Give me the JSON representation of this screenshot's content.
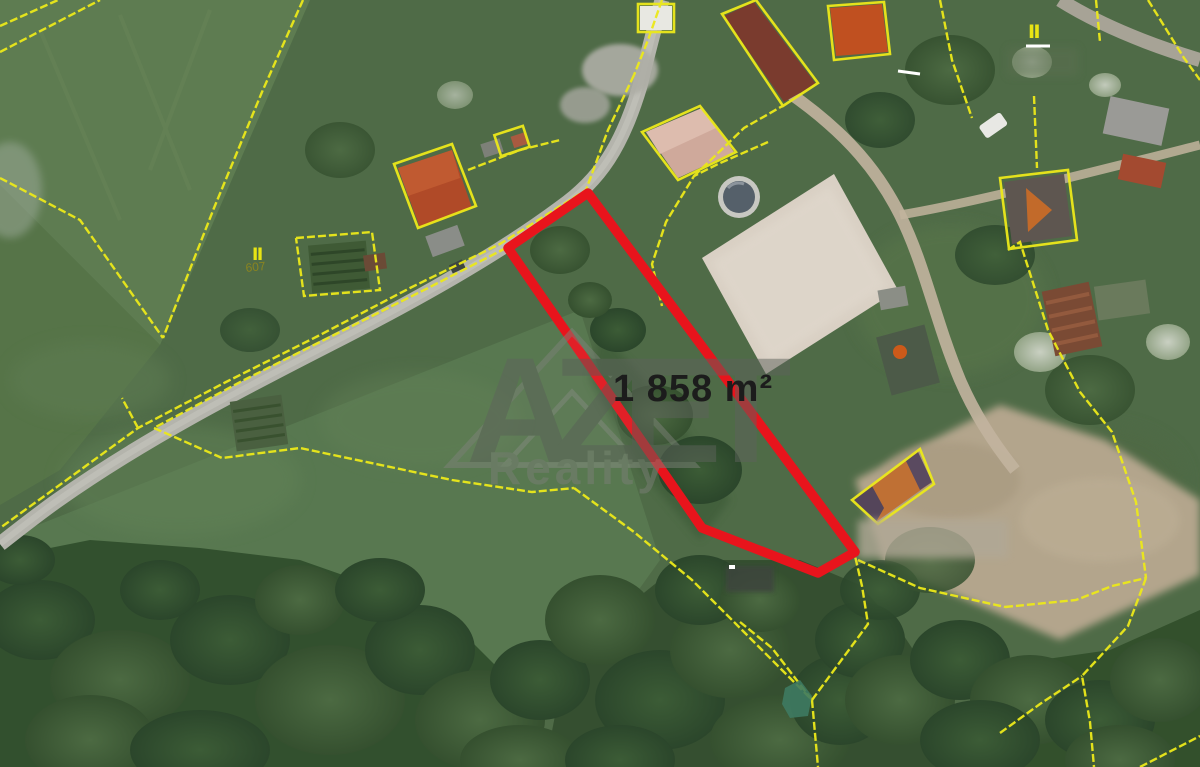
{
  "map": {
    "area_label": "1 858 m²",
    "watermark_brand": "AZET",
    "watermark_sub": "Reality",
    "parcel_number": "607",
    "landuse_symbol": "Ⅱ"
  },
  "colors": {
    "parcel_outline": "#e8141c",
    "cadastral_yellow": "#ece91a",
    "area_label": "#1c1c1c",
    "watermark_gray": "#5e635c",
    "parcel_number_color": "#8a8420"
  }
}
